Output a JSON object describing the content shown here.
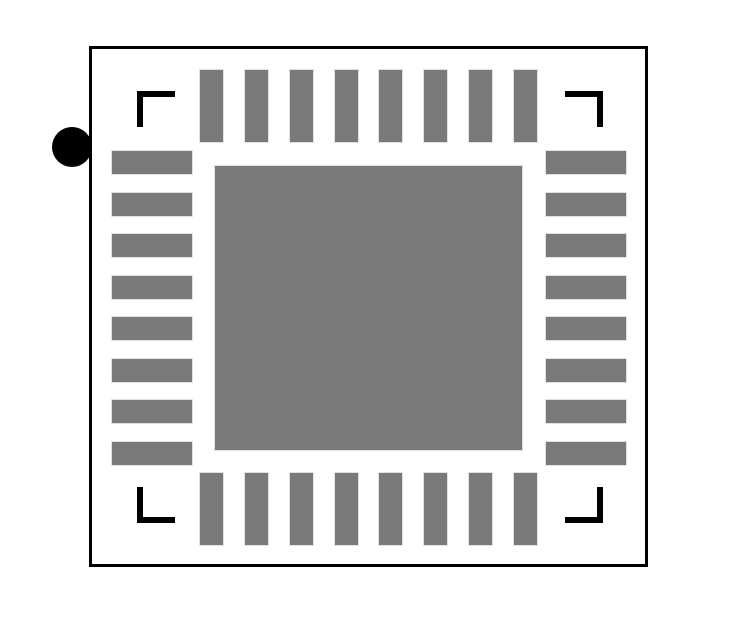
{
  "diagram": {
    "kind": "qfn-package-footprint",
    "package": {
      "total_pins": 32,
      "sides": [
        {
          "name": "top",
          "count": 8,
          "orientation": "vertical"
        },
        {
          "name": "bottom",
          "count": 8,
          "orientation": "vertical"
        },
        {
          "name": "left",
          "count": 8,
          "orientation": "horizontal"
        },
        {
          "name": "right",
          "count": 8,
          "orientation": "horizontal"
        }
      ],
      "center_pad": "exposed-thermal-pad",
      "pin1_marker": "filled-black-circle-outside-left-edge",
      "corner_fiducials": 4
    },
    "colors": {
      "pad_fill": "#7a7a7a",
      "outline": "#000000",
      "marker": "#000000",
      "background": "#ffffff"
    }
  }
}
